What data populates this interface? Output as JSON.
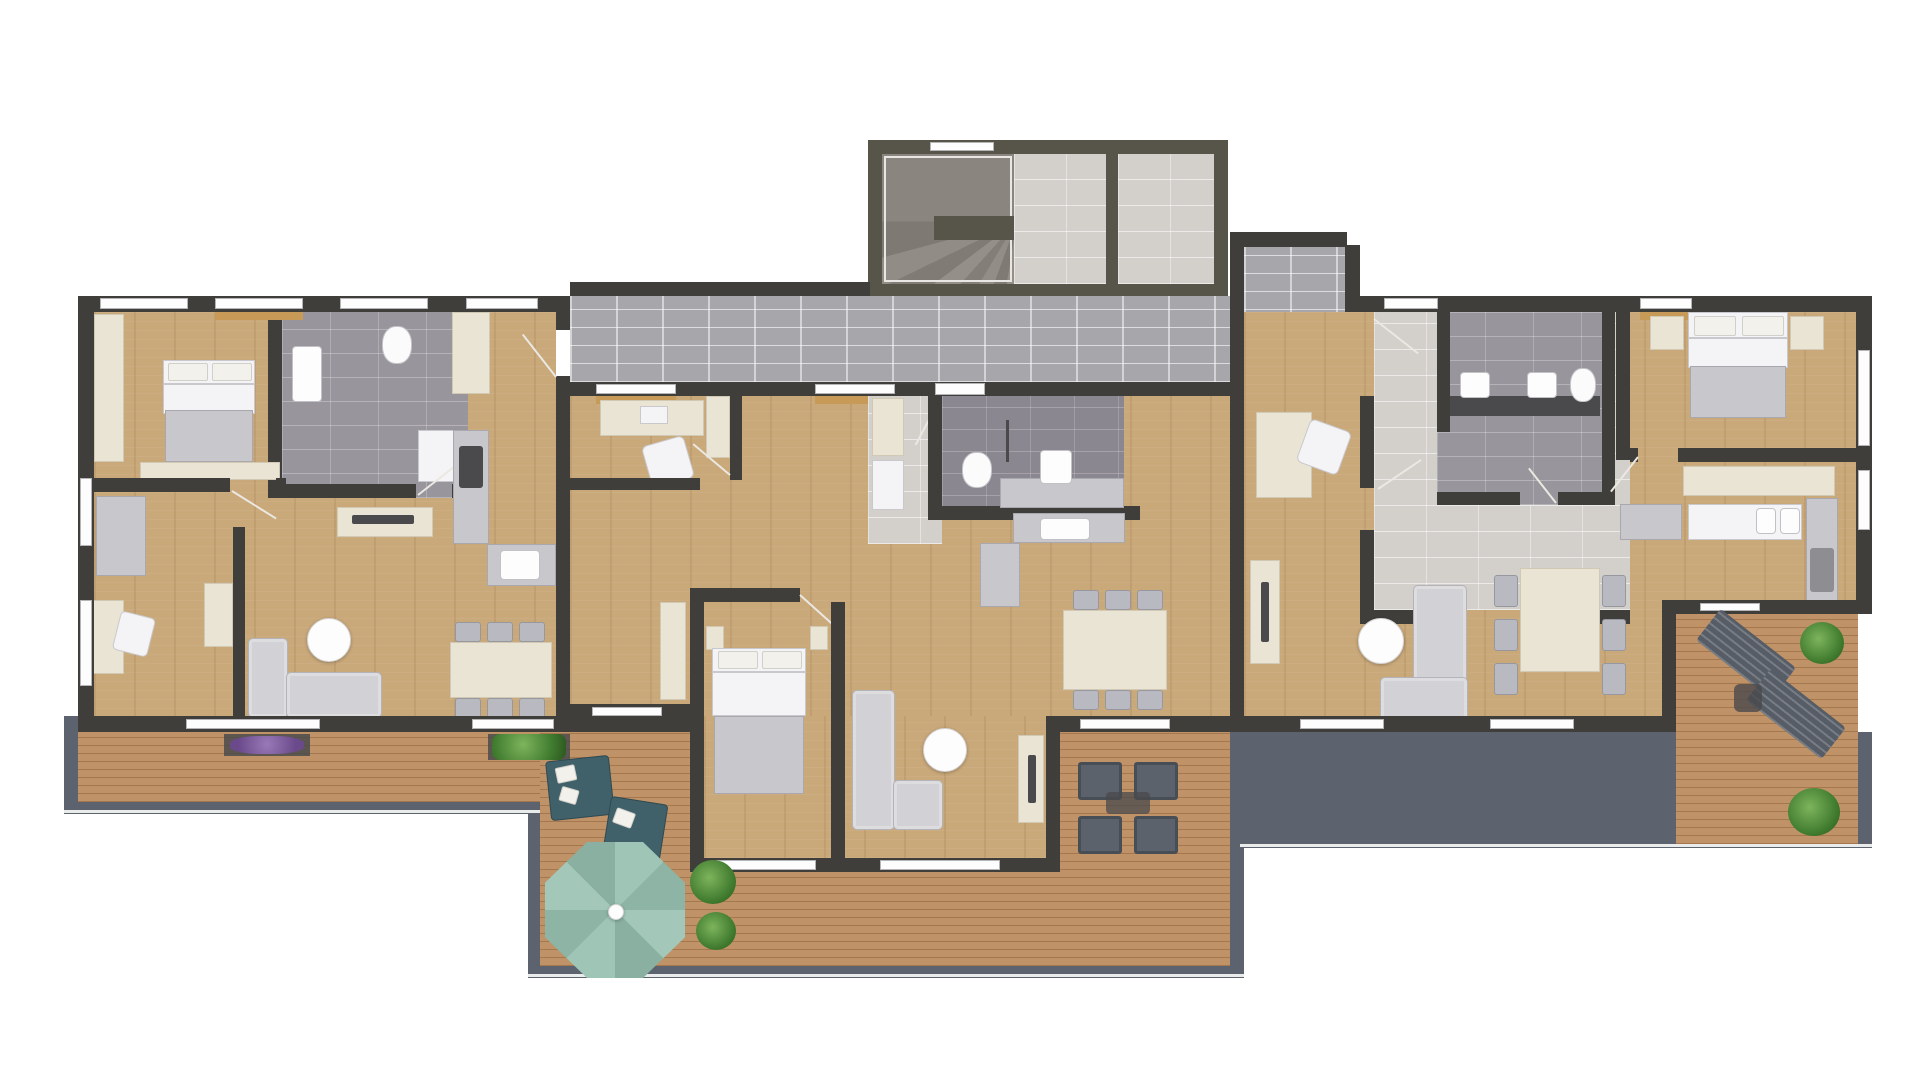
{
  "scene": {
    "type": "architectural-floor-plan",
    "view": "top-down 3D render",
    "units": 3,
    "background": "#ffffff",
    "visible_text": "none"
  },
  "palette": {
    "wall_dark": "#403e3a",
    "wall_olive": "#57544a",
    "wood_floor": "#c9a87a",
    "deck_wood": "#c09267",
    "balcony_slab": "#5c636e",
    "tile_light": "#d3d0cc",
    "tile_medium": "#98959c",
    "tile_dark": "#8a8790",
    "corridor_brick": "#a7a6aa",
    "furniture_white": "#f4f4f6",
    "furniture_gray": "#c7c7cc",
    "furniture_cream": "#eae4d4",
    "sofa_gray": "#d2d2d6",
    "outdoor_teal": "#40606a",
    "parasol_teal": "#93bcae",
    "plant_green": "#4a7d3a",
    "flower_purple": "#7a5a9a",
    "window_sill_oak": "#c79a57"
  },
  "stairwell": {
    "elements": [
      "winder-staircase",
      "stair-landing",
      "storage-room"
    ]
  },
  "corridor": {
    "floor": "gray brick tiles",
    "connects": [
      "stairwell",
      "all three apartments"
    ]
  },
  "apartments": [
    {
      "id": "left-apartment",
      "rooms": [
        "bedroom",
        "bathroom",
        "kitchen",
        "living-dining-room",
        "workspace"
      ],
      "furniture": [
        "double-bed",
        "wardrobe-column",
        "foot-bench",
        "dresser",
        "desk",
        "desk-chair",
        "washbasin",
        "toilet",
        "shower",
        "fridge-cabinet",
        "kitchen-counter-l",
        "tv-sideboard",
        "corner-sofa",
        "round-coffee-table",
        "console-table",
        "dining-table",
        "six-dining-chairs"
      ]
    },
    {
      "id": "middle-apartment",
      "rooms": [
        "workspace",
        "entry-hall",
        "bathroom",
        "kitchen",
        "living-dining-room",
        "bedroom"
      ],
      "furniture": [
        "desk",
        "desk-chair",
        "wardrobe",
        "hall-closet",
        "toilet",
        "washbasin-counter",
        "kitchen-counter-l",
        "dining-table",
        "six-dining-chairs",
        "double-bed",
        "wardrobe-column",
        "corner-sofa",
        "round-coffee-table",
        "tv-sideboard"
      ]
    },
    {
      "id": "right-apartment",
      "rooms": [
        "study",
        "entry-hall",
        "bathroom",
        "bedroom",
        "kitchen",
        "living-dining-room"
      ],
      "furniture": [
        "desk",
        "desk-chair",
        "tv-sideboard",
        "double-sink-counter",
        "toilet",
        "shower",
        "double-bed",
        "two-nightstands",
        "kitchen-counter-l",
        "kitchen-island-cream",
        "dining-table",
        "six-dining-chairs",
        "corner-sofa",
        "round-coffee-table"
      ]
    }
  ],
  "terraces": {
    "left": [
      "purple-flower-planter",
      "green-planter"
    ],
    "center": [
      "octagonal-parasol",
      "two-teal-outdoor-sofas",
      "white-cushions",
      "potted-plants",
      "four-outdoor-armchairs",
      "outdoor-coffee-table"
    ],
    "right": [
      "two-sun-loungers",
      "outdoor-side-table",
      "potted-plants"
    ]
  }
}
